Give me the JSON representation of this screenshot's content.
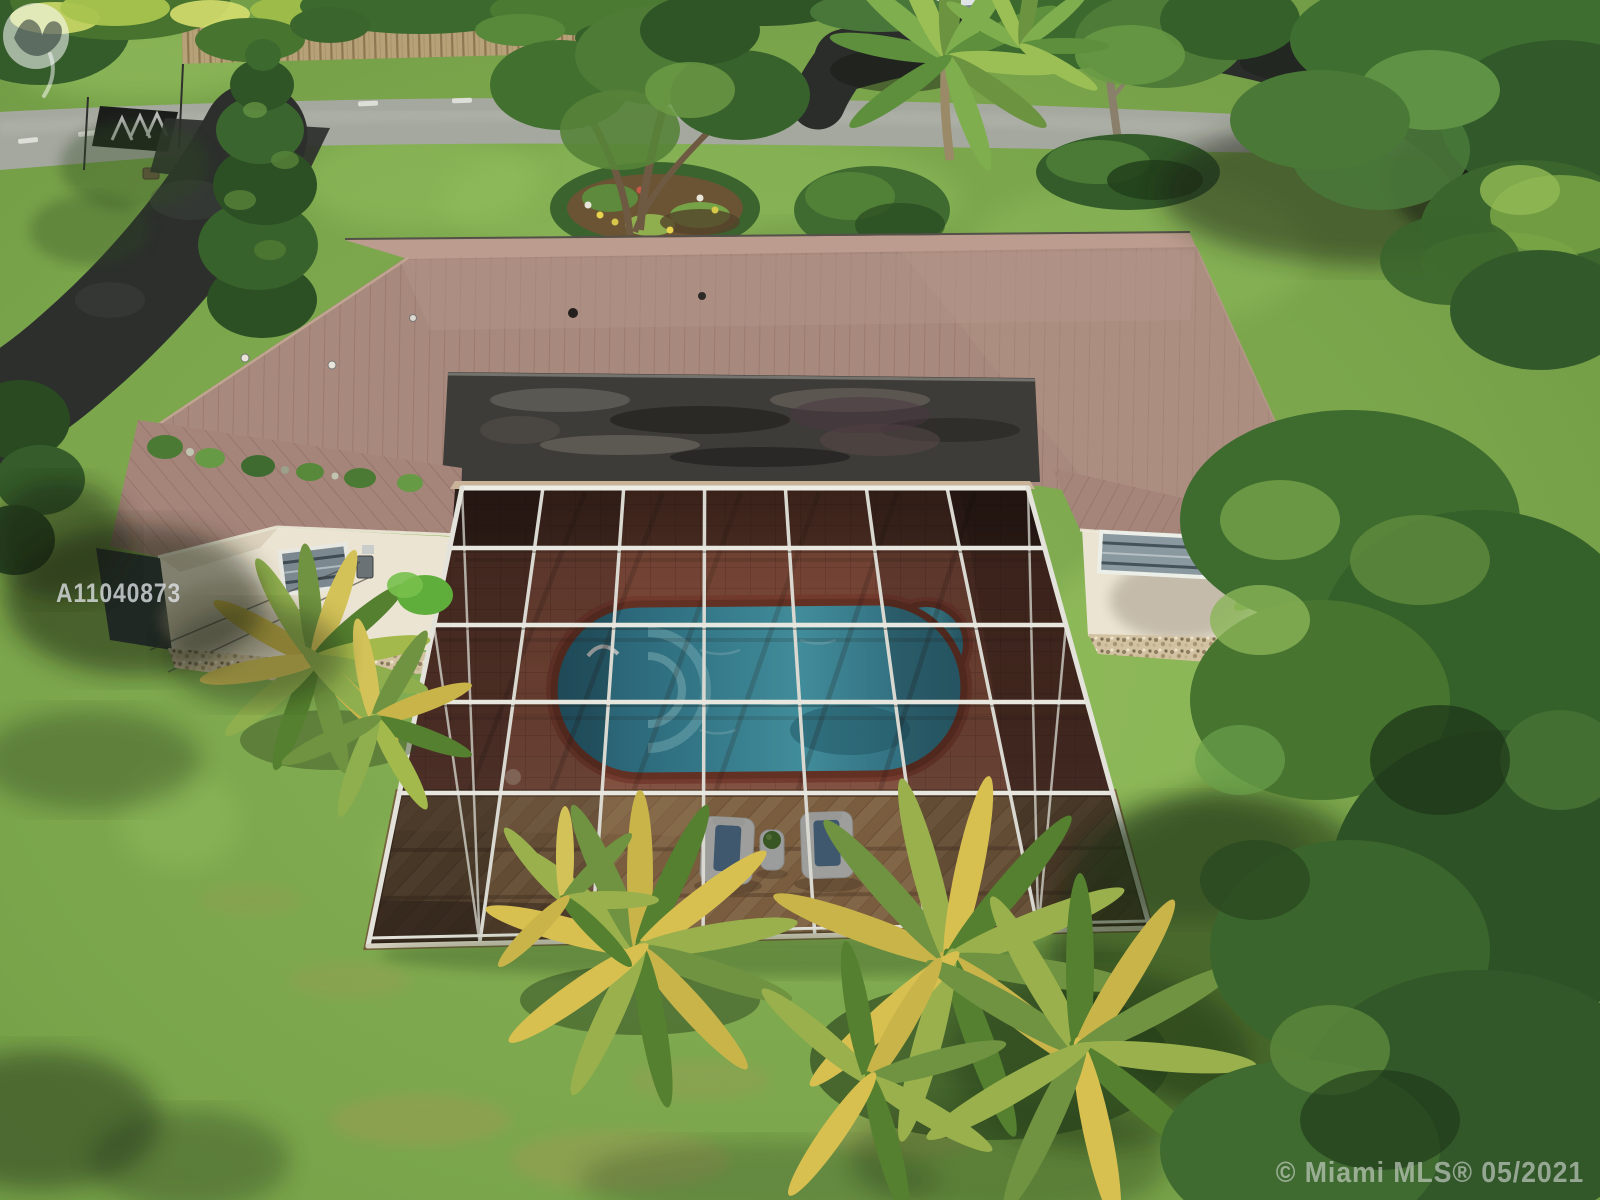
{
  "scene": {
    "type": "aerial-drone-photo",
    "subject": "single-family home with mauve metal roof, screened pool enclosure, oval pool on brick deck, wood sun deck, circular asphalt driveway, road with crosswalk, lawns and tropical trees",
    "visible_objects": [
      "road",
      "crosswalk-patch",
      "asphalt-driveway",
      "circular-driveway-loop",
      "parked-suv",
      "metal-roof",
      "weathered-flat-roof-strip",
      "house-gable-walls",
      "jalousie-windows",
      "screen-enclosure",
      "oval-pool",
      "spa-bump",
      "brick-paver-deck",
      "herringbone-wood-deck",
      "lounge-chairs",
      "side-table",
      "garden-bed",
      "hedge-ring",
      "conifer-tree",
      "palm-trees",
      "large-shade-trees",
      "lawn",
      "gravel-beds"
    ]
  },
  "watermarks": {
    "logo_icon": "miami-mls-logo",
    "listing_id": "A11040873",
    "copyright": "© Miami MLS® 05/2021"
  },
  "palette": {
    "roof": "#a8897d",
    "flat_roof": "#3e3c38",
    "house_wall": "#ece4d2",
    "pool_water": "#3f98ad",
    "pool_coping": "#7a3a2b",
    "brick_deck": "#9b5b46",
    "wood_deck": "#c09868",
    "screen_frame": "#e3e3db",
    "screen_mesh": "#141009",
    "lawn": "#7ca74c",
    "road": "#a5a89f",
    "asphalt": "#2c2f2c"
  }
}
